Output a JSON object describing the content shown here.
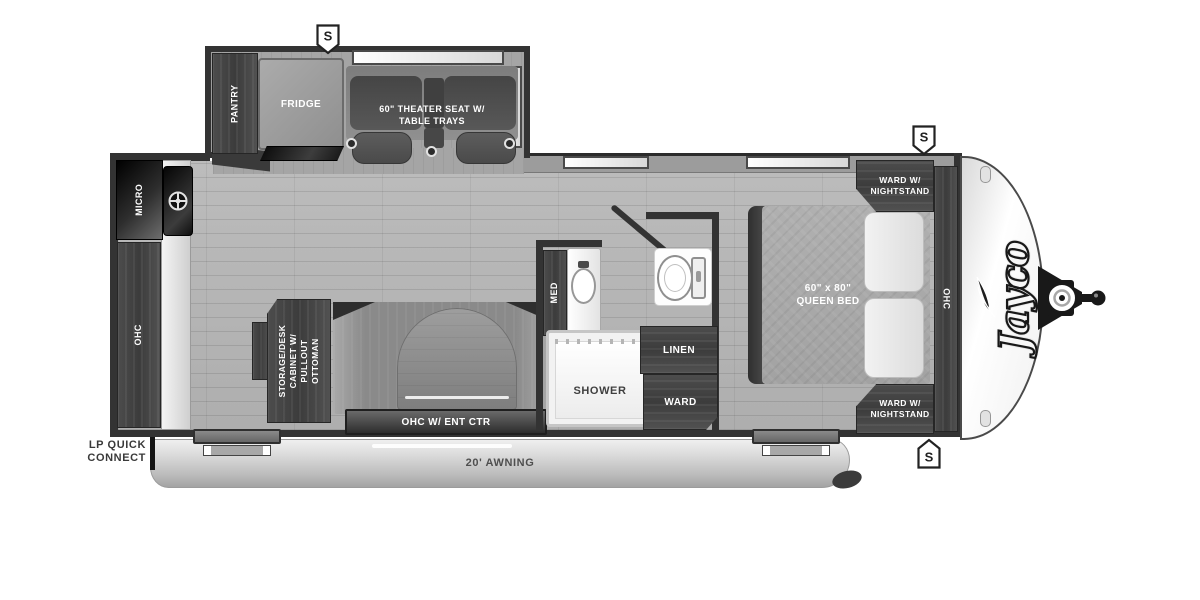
{
  "meta": {
    "title": "Jayco travel trailer floorplan"
  },
  "brand": {
    "name": "Jayco"
  },
  "markers": {
    "speaker": "S"
  },
  "labels": {
    "pantry": "PANTRY",
    "fridge": "FRIDGE",
    "theater_seat": "60\" THEATER SEAT W/\nTABLE TRAYS",
    "micro": "MICRO",
    "kitchen_ohc": "OHC",
    "med": "MED",
    "shower": "SHOWER",
    "linen": "LINEN",
    "ward": "WARD",
    "storage_desk": "STORAGE/DESK\nCABINET W/\nPULLOUT OTTOMAN",
    "ohc_ent_ctr": "OHC W/ ENT CTR",
    "ward_nightstand_top": "WARD W/\nNIGHTSTAND",
    "ward_nightstand_bottom": "WARD W/\nNIGHTSTAND",
    "queen_bed": "60\" x 80\"\nQUEEN BED",
    "bedroom_ohc": "OHC",
    "awning": "20' AWNING",
    "lp_quick_connect": "LP QUICK\nCONNECT"
  },
  "colors": {
    "wall": "#333333",
    "cabinet": "#464646",
    "floor": "#b5b5b5",
    "awning_text": "#4f4f4f",
    "label_text": "#ffffff"
  }
}
